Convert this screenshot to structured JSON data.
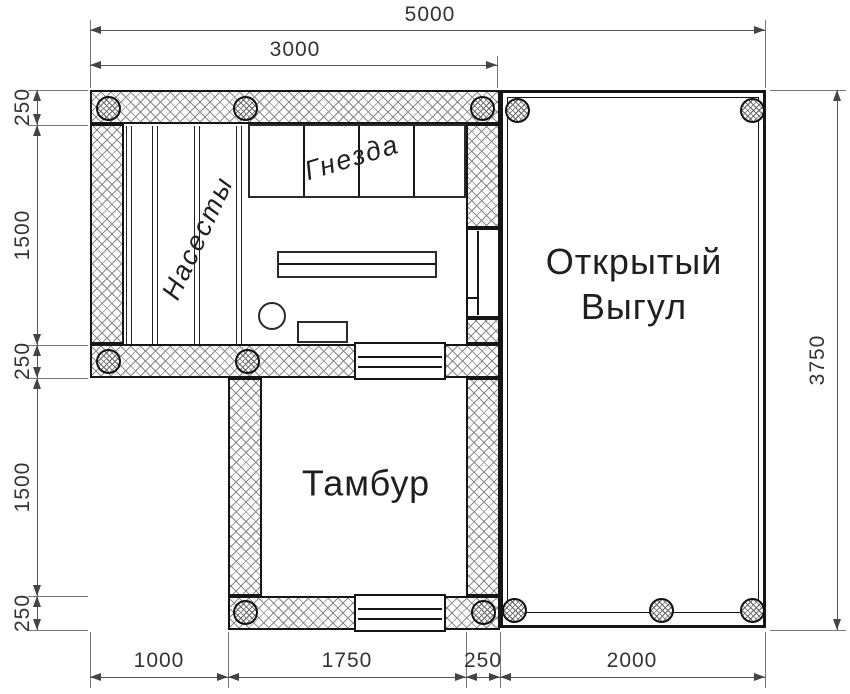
{
  "rooms": {
    "perches": "Насесты",
    "nests": "Гнезда",
    "open_run_line1": "Открытый",
    "open_run_line2": "Выгул",
    "vestibule": "Тамбур"
  },
  "dimensions_mm": {
    "top_total": "5000",
    "top_coop": "3000",
    "left": [
      "250",
      "1500",
      "250",
      "1500",
      "250"
    ],
    "right_total": "3750",
    "bottom": [
      "1000",
      "1750",
      "250",
      "2000"
    ]
  },
  "colors": {
    "line": "#161616",
    "dimension": "#555555",
    "hatch": "#8a8a8a",
    "background": "#ffffff"
  }
}
